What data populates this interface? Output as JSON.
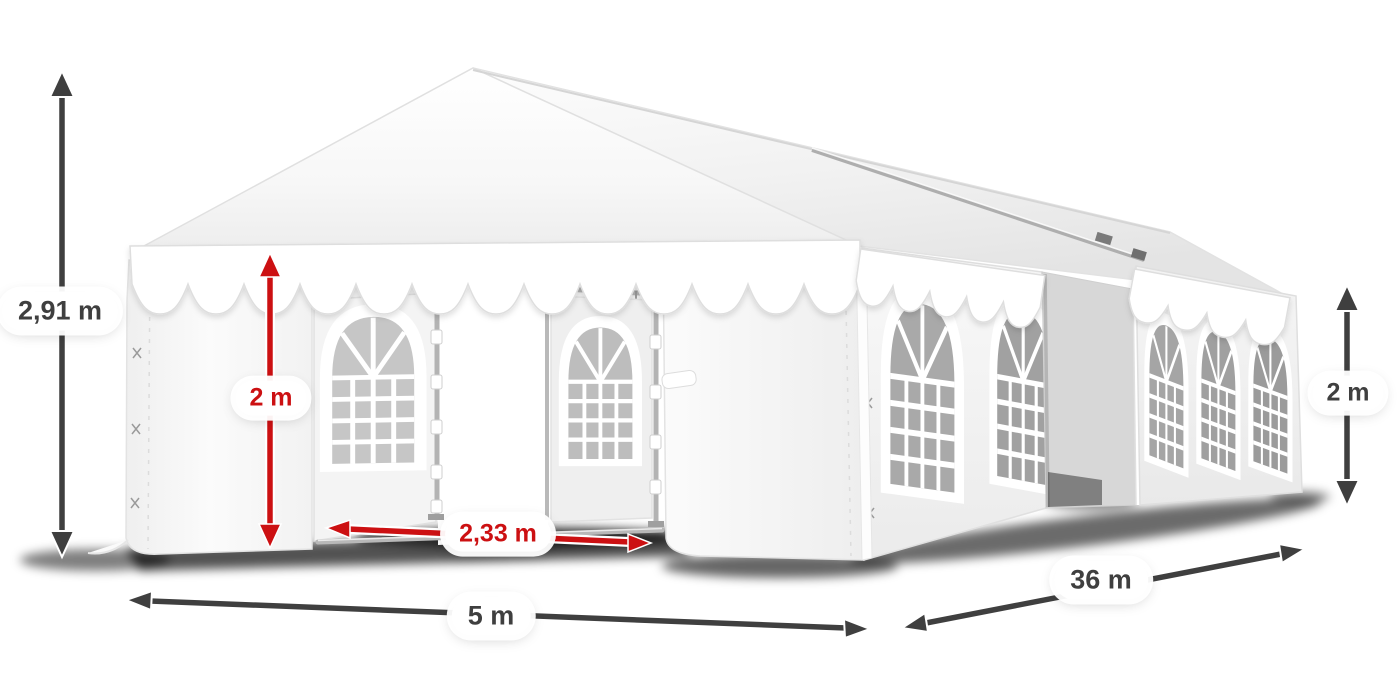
{
  "title": "Party tent dimensions diagram",
  "illustration": {
    "subject": "white marquee party tent with arched windows, front doors open",
    "sections": 2,
    "front_section_side_windows": 2,
    "rear_section_side_windows": 3
  },
  "colors": {
    "background": "#ffffff",
    "dimension_dark": "#3f3f3f",
    "dimension_red": "#cc1012",
    "tent_white": "#ffffff",
    "window_glass": "#a9a9a9"
  },
  "dimensions": [
    {
      "id": "total-height",
      "label": "2,91 m",
      "color": "dark",
      "orientation": "vertical"
    },
    {
      "id": "entrance-height",
      "label": "2 m",
      "color": "red",
      "orientation": "vertical"
    },
    {
      "id": "entrance-width",
      "label": "2,33 m",
      "color": "red",
      "orientation": "horizontal"
    },
    {
      "id": "width",
      "label": "5 m",
      "color": "dark",
      "orientation": "horizontal"
    },
    {
      "id": "length",
      "label": "36 m",
      "color": "dark",
      "orientation": "diagonal"
    },
    {
      "id": "side-height",
      "label": "2 m",
      "color": "dark",
      "orientation": "vertical"
    }
  ]
}
